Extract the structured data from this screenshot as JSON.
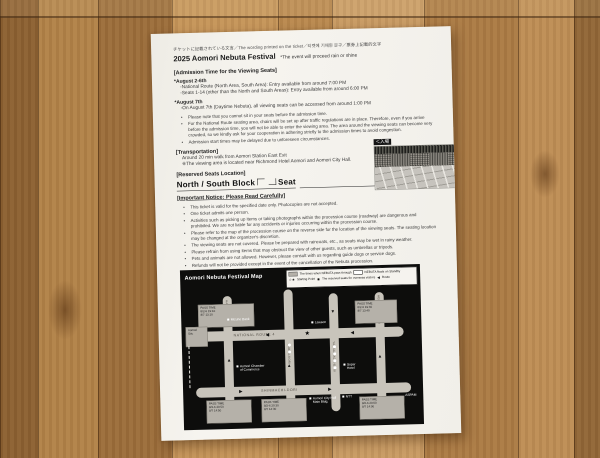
{
  "page": {
    "ticket_note": "チケットに記載されている文言／The wording printed on the ticket／티켓에 기재된 문구／票券上記載的文字",
    "title": "2025 Aomori Nebuta Festival",
    "title_note": "*The event will proceed rain or shine",
    "admission": {
      "heading": "[Admission Time for the Viewing Seats]",
      "period1": "*August 2-6th",
      "period1_lines": [
        "-National Route (North Area, South Area): Entry available from around 7:00 PM",
        "-Seats 1-14 (other than the North and South Areas): Entry available from around 6:00 PM"
      ],
      "period2": "*August 7th",
      "period2_line": "-On August 7th (Daytime Nebuta), all viewing seats can be accessed from around 1:00 PM",
      "bullets": [
        "Please note that you cannot sit in your seats before the admission time.",
        "For the National Route seating area, chairs will be set up after traffic regulations are in place. Therefore, even if you arrive before the admission time, you will not be able to enter the viewing area. The area around the viewing seats can become very crowded, so we kindly ask for your cooperation in adhering strictly to the admission times to avoid congestion.",
        "Admission start times may be delayed due to unforeseen circumstances."
      ]
    },
    "transportation": {
      "heading": "[Transportation]",
      "line1": "Around 20 min walk from Aomori Station East Exit",
      "line2": "※The viewing area is located near Richmond Hotel Aomori and Aomori City Hall."
    },
    "reserved": {
      "heading": "[Reserved Seats Location]",
      "prefix": "North / South Block",
      "suffix": "Seat"
    },
    "notice": {
      "heading": "[Important Notice: Please Read Carefully]",
      "items": [
        "This ticket is valid for the specified date only. Photocopies are not accepted.",
        "One ticket admits one person.",
        "Activities such as picking up items or taking photographs within the procession course (roadway) are dangerous and prohibited. We are not liable for any accidents or injuries occurring within the procession course.",
        "Please refer to the map of the procession course on the reverse side for the location of the viewing seats. The seating location may be changed at the organizer's discretion.",
        "The viewing seats are not covered. Please be prepared with raincoats, etc., as seats may be wet in rainy weather.",
        "Please refrain from using items that may obstruct the view of other guests, such as umbrellas or tripods.",
        "Pets and animals are not allowed. However, please consult with us regarding guide dogs or service dogs.",
        "Refunds will not be provided except in the event of the cancellation of the Nebuta procession.",
        "Please refrain from any behavior that may disturb other guests.",
        "Smoking is prohibited within the paid viewing area."
      ],
      "footer": "Please present this ticket to the staff. You will also need to show the ticket again for re-entry."
    },
    "photo_label": "＜入場"
  },
  "map": {
    "title": "Aomori Nebuta Festival  Map",
    "legend": {
      "pass": "The times when NEBUTA pass through",
      "standby": "NEBUTA floats on Standby",
      "start_icons": "☆★",
      "start": "Starting Point",
      "overseas_icon": "◉",
      "overseas": "The reserved seats for overseas visitors",
      "route_icon": "◀",
      "route": "Route"
    },
    "streets": {
      "top": "NATIONAL ROUTE 4",
      "bottom": "SHINMACHI-DORI",
      "v1": "HAKKO-DORI",
      "v2": "SHOWA-DORI",
      "v3": "YANAGIMACHI-DORI",
      "v4": "HEIWA-KOEN-DORI"
    },
    "pois": {
      "mizuho": "Mizuho Bank",
      "lawson": "Lawson",
      "super_hotel": "Super\nHotel",
      "ntt": "NTT",
      "city_hall": "Aomori City Hall\nMain Bldg.",
      "chamber": "Aomori Chamber\nof Commerce",
      "aspam": "ASPAM"
    },
    "time_boxes": {
      "tb1": "PASS TIME\n8/2-6 19:10\n8/7 13:10",
      "tb2": "PASS TIME\n8/2-6 19:40\n8/7 13:40",
      "station": "Aomori\nSta.",
      "bb1": "PASS TIME\n8/2-6 20:50\n8/7 14:50",
      "bb2": "PASS TIME\n8/2-6 20:30\n8/7 14:30",
      "bb3": "PASS TIME\n8/2-6 20:00\n8/7 14:00"
    }
  },
  "colors": {
    "paper": "#f4f2ec",
    "map_bg": "#0d0d0c",
    "road": "#c8c4bb",
    "wood": "#b8884e"
  }
}
